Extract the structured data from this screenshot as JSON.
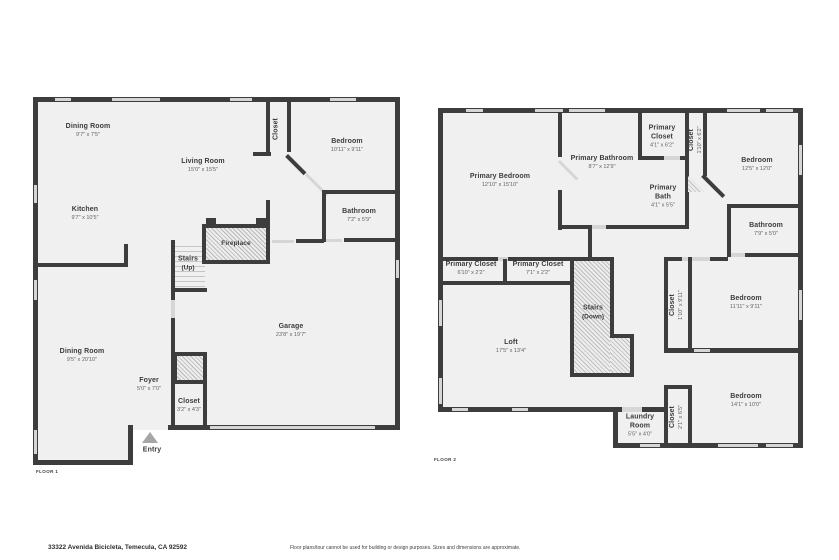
{
  "page": {
    "address": "33322 Avenida Bicicleta, Temecula, CA 92592",
    "disclaimer": "Floor plans/tour cannot be used for building or design purposes. Sizes and dimensions are approximate."
  },
  "colors": {
    "wall": "#3d3d3d",
    "room_fill": "#f1f0f0",
    "window": "#d6d6d6",
    "text": "#3c3c3c"
  },
  "floor1": {
    "label": "FLOOR 1",
    "entry": "Entry",
    "rooms": [
      {
        "name": "Dining Room",
        "dims": "9'7\" x 7'5\""
      },
      {
        "name": "Living Room",
        "dims": "15'0\" x 15'5\""
      },
      {
        "name": "Kitchen",
        "dims": "9'7\" x 10'5\""
      },
      {
        "name": "Closet",
        "dims": ""
      },
      {
        "name": "Bedroom",
        "dims": "10'11\" x 9'11\""
      },
      {
        "name": "Bathroom",
        "dims": "7'2\" x 5'9\""
      },
      {
        "name": "Fireplace",
        "dims": ""
      },
      {
        "name": "Stairs",
        "dims": "(Up)"
      },
      {
        "name": "Garage",
        "dims": "23'8\" x 19'7\""
      },
      {
        "name": "Dining Room",
        "dims": "9'5\" x 20'10\""
      },
      {
        "name": "Foyer",
        "dims": "5'0\" x 7'0\""
      },
      {
        "name": "Closet",
        "dims": "3'2\" x 4'3\""
      }
    ]
  },
  "floor2": {
    "label": "FLOOR 2",
    "rooms": [
      {
        "name": "Primary Bedroom",
        "dims": "12'10\" x 15'10\""
      },
      {
        "name": "Primary Bathroom",
        "dims": "8'7\" x 12'9\""
      },
      {
        "name": "Primary Closet",
        "dims": "4'1\" x 6'2\""
      },
      {
        "name": "Closet",
        "dims": "1'10\" x 6'2\""
      },
      {
        "name": "Bedroom",
        "dims": "12'5\" x 12'0\""
      },
      {
        "name": "Primary Bath",
        "dims": "4'1\" x 5'5\""
      },
      {
        "name": "Bathroom",
        "dims": "7'9\" x 5'0\""
      },
      {
        "name": "Primary Closet",
        "dims": "6'10\" x 2'2\""
      },
      {
        "name": "Primary Closet",
        "dims": "7'1\" x 2'2\""
      },
      {
        "name": "Stairs",
        "dims": "(Down)"
      },
      {
        "name": "Loft",
        "dims": "17'5\" x 13'4\""
      },
      {
        "name": "Closet",
        "dims": "1'10\" x 9'11\""
      },
      {
        "name": "Bedroom",
        "dims": "11'11\" x 9'11\""
      },
      {
        "name": "Bedroom",
        "dims": "14'1\" x 10'0\""
      },
      {
        "name": "Closet",
        "dims": "2'1\" x 6'5\""
      },
      {
        "name": "Laundry Room",
        "dims": "5'5\" x 4'0\""
      }
    ]
  }
}
